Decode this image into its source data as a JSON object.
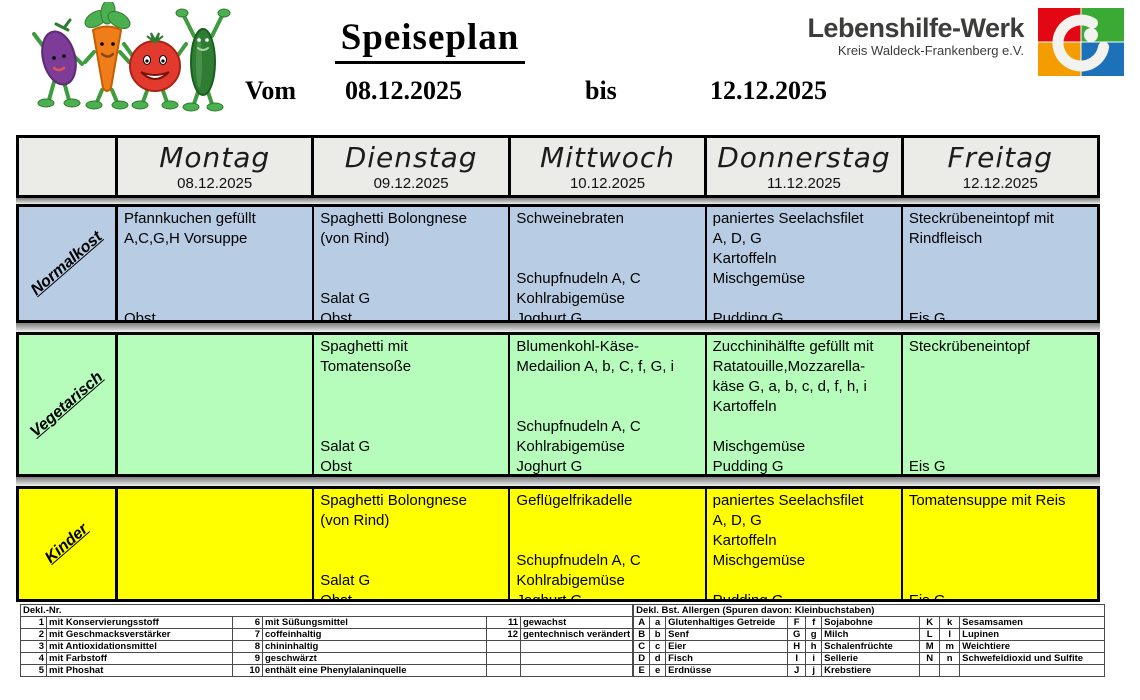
{
  "header": {
    "title": "Speiseplan",
    "vom_label": "Vom",
    "vom_date": "08.12.2025",
    "bis_label": "bis",
    "bis_date": "12.12.2025",
    "org_name": "Lebenshilfe-Werk",
    "org_subtitle": "Kreis Waldeck-Frankenberg e.V."
  },
  "colors": {
    "normalkost_row": "#b8cce4",
    "vegetarisch_row": "#b6fdbc",
    "kinder_row": "#ffff00",
    "day_header_bg": "#ebebe8",
    "logo_red": "#e30613",
    "logo_green": "#3aaa35",
    "logo_orange": "#f59c00",
    "logo_blue": "#1d71b8"
  },
  "menu": {
    "days": [
      {
        "name": "Montag",
        "date": "08.12.2025"
      },
      {
        "name": "Dienstag",
        "date": "09.12.2025"
      },
      {
        "name": "Mittwoch",
        "date": "10.12.2025"
      },
      {
        "name": "Donnerstag",
        "date": "11.12.2025"
      },
      {
        "name": "Freitag",
        "date": "12.12.2025"
      }
    ],
    "rows": [
      {
        "label": "Normalkost",
        "cells": [
          "Pfannkuchen gefüllt\nA,C,G,H Vorsuppe\n\n\n\nObst",
          "Spaghetti Bolongnese\n(von Rind)\n\n\nSalat G\nObst",
          "Schweinebraten\n\n\nSchupfnudeln A, C\nKohlrabigemüse\nJoghurt G",
          "paniertes Seelachsfilet\nA, D, G\nKartoffeln\nMischgemüse\n\nPudding G",
          "Steckrübeneintopf mit\nRindfleisch\n\n\n\nEis G"
        ]
      },
      {
        "label": "Vegetarisch",
        "cells": [
          "",
          "Spaghetti mit\nTomatensoße\n\n\n\nSalat G\nObst",
          "Blumenkohl-Käse-\nMedailion A, b, C, f, G, i\n\n\nSchupfnudeln A, C\nKohlrabigemüse\nJoghurt G",
          "Zucchinihälfte gefüllt mit\nRatatouille,Mozzarella-\nkäse G, a, b, c, d, f, h, i\nKartoffeln\n\nMischgemüse\nPudding G",
          "Steckrübeneintopf\n\n\n\n\n\nEis G"
        ]
      },
      {
        "label": "Kinder",
        "cells": [
          "",
          "Spaghetti Bolongnese\n(von Rind)\n\n\nSalat G\nObst",
          "Geflügelfrikadelle\n\n\nSchupfnudeln A, C\nKohlrabigemüse\nJoghurt G",
          "paniertes Seelachsfilet\nA, D, G\nKartoffeln\nMischgemüse\n\nPudding G",
          "Tomatensuppe mit Reis\n\n\n\n\nEis G"
        ]
      }
    ]
  },
  "legend": {
    "left_title": "Dekl.-Nr.",
    "left_rows": [
      [
        "1",
        "mit Konservierungsstoff",
        "6",
        "mit Süßungsmittel",
        "11",
        "gewachst"
      ],
      [
        "2",
        "mit Geschmacksverstärker",
        "7",
        "coffeinhaltig",
        "12",
        "gentechnisch verändert"
      ],
      [
        "3",
        "mit Antioxidationsmittel",
        "8",
        "chininhaltig",
        "",
        ""
      ],
      [
        "4",
        "mit Farbstoff",
        "9",
        "geschwärzt",
        "",
        ""
      ],
      [
        "5",
        "mit Phoshat",
        "10",
        "enthält eine Phenylalaninquelle",
        "",
        ""
      ]
    ],
    "right_title": "Dekl. Bst. Allergen (Spuren davon: Kleinbuchstaben)",
    "right_rows": [
      [
        "A",
        "a",
        "Glutenhaltiges Getreide",
        "F",
        "f",
        "Sojabohne",
        "K",
        "k",
        "Sesamsamen"
      ],
      [
        "B",
        "b",
        "Senf",
        "G",
        "g",
        "Milch",
        "L",
        "l",
        "Lupinen"
      ],
      [
        "C",
        "c",
        "Eier",
        "H",
        "h",
        "Schalenfrüchte",
        "M",
        "m",
        "Weichtiere"
      ],
      [
        "D",
        "d",
        "Fisch",
        "I",
        "i",
        "Sellerie",
        "N",
        "n",
        "Schwefeldioxid und Sulfite"
      ],
      [
        "E",
        "e",
        "Erdnüsse",
        "J",
        "j",
        "Krebstiere",
        "",
        "",
        ""
      ]
    ]
  }
}
